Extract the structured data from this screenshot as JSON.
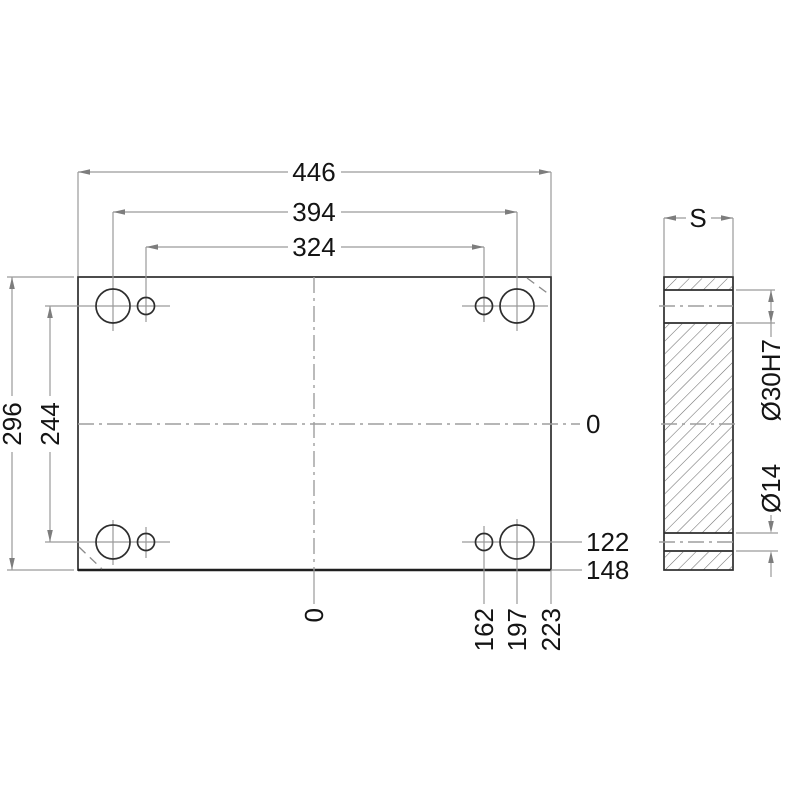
{
  "colors": {
    "background": "#ffffff",
    "object_line": "#2d2d2d",
    "dimension_line": "#9a9a9a",
    "hatch_line": "#6f6f6f",
    "text": "#141414"
  },
  "front_view": {
    "dims": {
      "overall_width": "446",
      "large_hole_spacing_x": "394",
      "small_hole_spacing_x": "324",
      "overall_height": "296",
      "hole_spacing_y": "244"
    },
    "ordinates_right": {
      "centerline": "0",
      "hole_row": "122",
      "bottom_edge": "148"
    },
    "ordinates_bottom": {
      "centerline": "0",
      "small_hole": "162",
      "large_hole": "197",
      "right_edge": "223"
    }
  },
  "side_view": {
    "dims": {
      "thickness": "S",
      "large_bore": "Ø30H7",
      "small_bore": "Ø14"
    }
  }
}
